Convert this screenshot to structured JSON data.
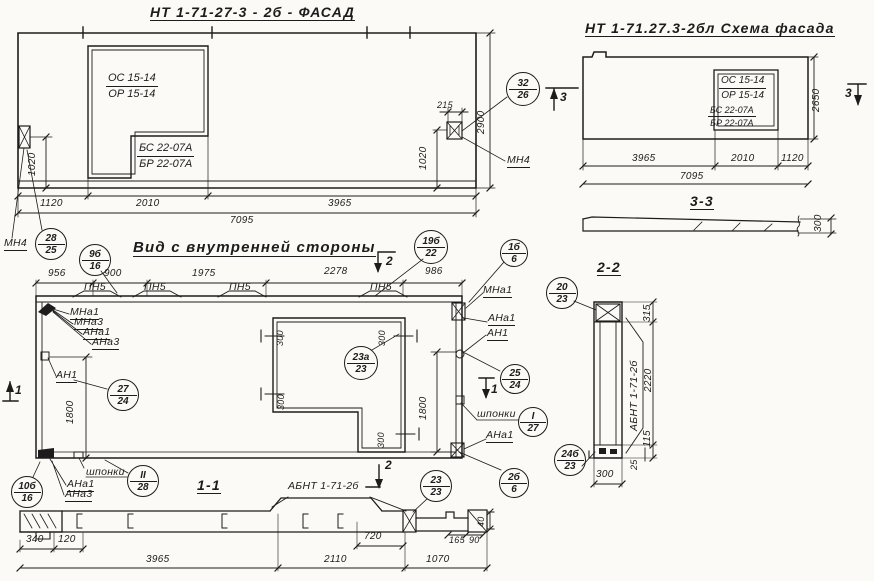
{
  "ink": "#1c1c1c",
  "paper": "#fbfaf6",
  "titles": [
    {
      "t": "НТ 1-71-27-3 - 2б - ФАСАД",
      "x": 150,
      "y": 5,
      "u": 1
    },
    {
      "t": "НТ 1-71.27.3-2бл Схема фасада",
      "x": 585,
      "y": 21,
      "u": 1
    },
    {
      "t": "Вид с внутренней стороны",
      "x": 133,
      "y": 240,
      "u": 1,
      "fs": 15
    },
    {
      "t": "1-1",
      "x": 197,
      "y": 478,
      "u": 1
    },
    {
      "t": "2-2",
      "x": 597,
      "y": 260,
      "u": 1
    },
    {
      "t": "3-3",
      "x": 690,
      "y": 194,
      "u": 1
    }
  ],
  "markers": [
    {
      "t": "3",
      "x": 560,
      "y": 91
    },
    {
      "t": "3",
      "x": 845,
      "y": 87
    },
    {
      "t": "2",
      "x": 386,
      "y": 255
    },
    {
      "t": "2",
      "x": 385,
      "y": 459
    },
    {
      "t": "1",
      "x": 491,
      "y": 383
    },
    {
      "t": "1",
      "x": 15,
      "y": 384
    }
  ],
  "dims": [
    {
      "t": "1120",
      "x": 40,
      "y": 199
    },
    {
      "t": "2010",
      "x": 136,
      "y": 199
    },
    {
      "t": "3965",
      "x": 328,
      "y": 199
    },
    {
      "t": "7095",
      "x": 230,
      "y": 216
    },
    {
      "t": "215",
      "x": 437,
      "y": 101,
      "fs": 9
    },
    {
      "t": "1020",
      "x": 28,
      "y": 176,
      "rot": 1
    },
    {
      "t": "1020",
      "x": 419,
      "y": 170,
      "rot": 1
    },
    {
      "t": "2900",
      "x": 477,
      "y": 134,
      "rot": 1
    },
    {
      "t": "3965",
      "x": 632,
      "y": 154
    },
    {
      "t": "2010",
      "x": 731,
      "y": 154
    },
    {
      "t": "1120",
      "x": 781,
      "y": 154
    },
    {
      "t": "7095",
      "x": 680,
      "y": 172
    },
    {
      "t": "2650",
      "x": 812,
      "y": 112,
      "rot": 1
    },
    {
      "t": "300",
      "x": 814,
      "y": 232,
      "rot": 1
    },
    {
      "t": "956",
      "x": 48,
      "y": 269
    },
    {
      "t": "900",
      "x": 104,
      "y": 269
    },
    {
      "t": "1975",
      "x": 192,
      "y": 269
    },
    {
      "t": "2278",
      "x": 324,
      "y": 267
    },
    {
      "t": "986",
      "x": 425,
      "y": 267
    },
    {
      "t": "1800",
      "x": 66,
      "y": 424,
      "rot": 1
    },
    {
      "t": "1800",
      "x": 419,
      "y": 420,
      "rot": 1
    },
    {
      "t": "300",
      "x": 276,
      "y": 346,
      "rot": 1,
      "fs": 9
    },
    {
      "t": "300",
      "x": 378,
      "y": 346,
      "rot": 1,
      "fs": 9
    },
    {
      "t": "300",
      "x": 277,
      "y": 410,
      "rot": 1,
      "fs": 9
    },
    {
      "t": "300",
      "x": 377,
      "y": 448,
      "rot": 1,
      "fs": 9
    },
    {
      "t": "340",
      "x": 26,
      "y": 535
    },
    {
      "t": "120",
      "x": 58,
      "y": 535
    },
    {
      "t": "3965",
      "x": 146,
      "y": 555
    },
    {
      "t": "2110",
      "x": 324,
      "y": 555
    },
    {
      "t": "1070",
      "x": 426,
      "y": 555
    },
    {
      "t": "720",
      "x": 364,
      "y": 532
    },
    {
      "t": "165",
      "x": 449,
      "y": 536,
      "fs": 9
    },
    {
      "t": "90",
      "x": 469,
      "y": 536,
      "fs": 9
    },
    {
      "t": "40",
      "x": 477,
      "y": 527,
      "rot": 1,
      "fs": 9
    },
    {
      "t": "315",
      "x": 643,
      "y": 322,
      "rot": 1
    },
    {
      "t": "2220",
      "x": 644,
      "y": 392,
      "rot": 1
    },
    {
      "t": "115",
      "x": 643,
      "y": 447,
      "rot": 1
    },
    {
      "t": "25",
      "x": 630,
      "y": 470,
      "rot": 1,
      "fs": 9
    },
    {
      "t": "300",
      "x": 596,
      "y": 470
    }
  ],
  "labels": [
    {
      "t": "МН4",
      "x": 4,
      "y": 238,
      "u": 1
    },
    {
      "t": "МН4",
      "x": 507,
      "y": 155,
      "u": 1
    },
    {
      "t": "МНа1",
      "x": 70,
      "y": 307,
      "u": 1
    },
    {
      "t": "МНа3",
      "x": 74,
      "y": 317,
      "u": 1
    },
    {
      "t": "АНа1",
      "x": 83,
      "y": 327,
      "u": 1
    },
    {
      "t": "АНа3",
      "x": 92,
      "y": 337,
      "u": 1
    },
    {
      "t": "АН1",
      "x": 56,
      "y": 370,
      "u": 1
    },
    {
      "t": "ПН5",
      "x": 84,
      "y": 282
    },
    {
      "t": "ПН5",
      "x": 144,
      "y": 282
    },
    {
      "t": "ПН5",
      "x": 229,
      "y": 282
    },
    {
      "t": "ПН5",
      "x": 370,
      "y": 282
    },
    {
      "t": "МНа1",
      "x": 483,
      "y": 285,
      "u": 1
    },
    {
      "t": "АНа1",
      "x": 488,
      "y": 313,
      "u": 1
    },
    {
      "t": "АН1",
      "x": 487,
      "y": 328,
      "u": 1
    },
    {
      "t": "шпонки",
      "x": 477,
      "y": 409
    },
    {
      "t": "АНа1",
      "x": 486,
      "y": 430,
      "u": 1
    },
    {
      "t": "шпонки",
      "x": 86,
      "y": 467
    },
    {
      "t": "АНа1",
      "x": 67,
      "y": 479,
      "u": 1
    },
    {
      "t": "АНа3",
      "x": 65,
      "y": 489,
      "u": 1
    },
    {
      "t": "АБНТ 1-71-2б",
      "x": 288,
      "y": 481
    },
    {
      "t": "АБНТ 1-71-2б",
      "x": 629,
      "y": 431,
      "rot": 1
    }
  ],
  "fractions": [
    {
      "top": "ОС 15-14",
      "bottom": "ОР 15-14",
      "x": 106,
      "y": 72,
      "fs": 11
    },
    {
      "top": "БС 22-07А",
      "bottom": "БР 22-07А",
      "x": 137,
      "y": 142,
      "fs": 11
    },
    {
      "top": "ОС 15-14",
      "bottom": "ОР 15-14",
      "x": 719,
      "y": 75,
      "fs": 10
    },
    {
      "top": "БС 22-07А",
      "bottom": "БР 22-07А",
      "x": 708,
      "y": 105,
      "fs": 9
    }
  ],
  "callouts": [
    {
      "top": "32",
      "bottom": "26",
      "cx": 522,
      "cy": 88,
      "r": 16
    },
    {
      "top": "28",
      "bottom": "25",
      "cx": 50,
      "cy": 243,
      "r": 15
    },
    {
      "top": "9б",
      "bottom": "16",
      "cx": 94,
      "cy": 259,
      "r": 15
    },
    {
      "top": "19б",
      "bottom": "22",
      "cx": 430,
      "cy": 246,
      "r": 16
    },
    {
      "top": "1б",
      "bottom": "6",
      "cx": 513,
      "cy": 252,
      "r": 13
    },
    {
      "top": "27",
      "bottom": "24",
      "cx": 122,
      "cy": 394,
      "r": 15
    },
    {
      "top": "23а",
      "bottom": "23",
      "cx": 360,
      "cy": 362,
      "r": 16
    },
    {
      "top": "25",
      "bottom": "24",
      "cx": 514,
      "cy": 378,
      "r": 14
    },
    {
      "top": "I",
      "bottom": "27",
      "cx": 532,
      "cy": 421,
      "r": 14
    },
    {
      "top": "II",
      "bottom": "28",
      "cx": 142,
      "cy": 480,
      "r": 15
    },
    {
      "top": "10б",
      "bottom": "16",
      "cx": 26,
      "cy": 491,
      "r": 15
    },
    {
      "top": "23",
      "bottom": "23",
      "cx": 435,
      "cy": 485,
      "r": 15
    },
    {
      "top": "2б",
      "bottom": "6",
      "cx": 513,
      "cy": 482,
      "r": 14
    },
    {
      "top": "24б",
      "bottom": "23",
      "cx": 569,
      "cy": 459,
      "r": 15
    },
    {
      "top": "20",
      "bottom": "23",
      "cx": 561,
      "cy": 292,
      "r": 15
    }
  ]
}
